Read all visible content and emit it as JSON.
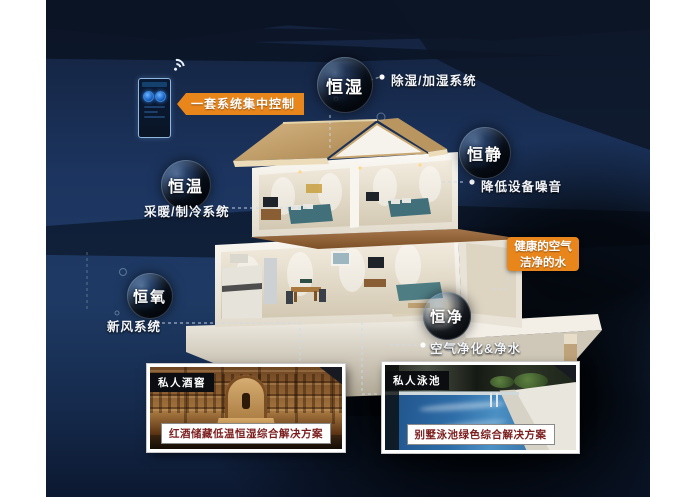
{
  "poster": {
    "control_label": "一套系统集中控制",
    "highlight_line1": "健康的空气",
    "highlight_line2": "洁净的水"
  },
  "bubbles": [
    {
      "label": "恒湿",
      "note": "除湿/加湿系统"
    },
    {
      "label": "恒静",
      "note": "降低设备噪音"
    },
    {
      "label": "恒温",
      "note": "采暖/制冷系统"
    },
    {
      "label": "恒氧",
      "note": "新风系统"
    },
    {
      "label": "恒净",
      "note": "空气净化&净水"
    }
  ],
  "cards": [
    {
      "tag": "私人酒窖",
      "caption": "红酒储藏低温恒湿综合解决方案"
    },
    {
      "tag": "私人泳池",
      "caption": "别墅泳池绿色综合解决方案"
    }
  ],
  "icons": {
    "wifi": "wifi-icon",
    "panel": "smart-control-panel"
  },
  "colors": {
    "accent_orange": "#E8861B",
    "caption_red": "#7B1D1D",
    "navy_base": "#1D3560"
  }
}
